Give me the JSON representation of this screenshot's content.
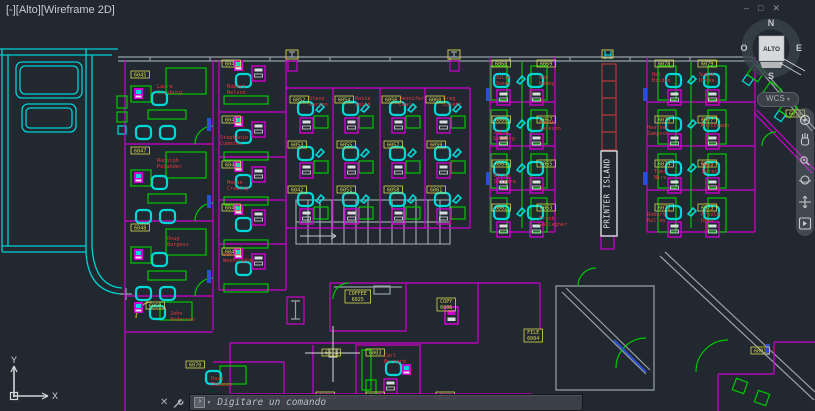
{
  "app": {
    "viewport_controls": [
      "[-]",
      "[Alto]",
      "[Wireframe 2D]"
    ],
    "window_buttons": {
      "minimize": "–",
      "restore": "□",
      "close": "✕"
    }
  },
  "viewcube": {
    "north": "N",
    "south": "S",
    "east": "E",
    "west": "O",
    "top_face": "ALTO",
    "wcs_label": "WCS",
    "wcs_dropdown": "▾"
  },
  "navbar": {
    "icons": [
      "navigation-wheel",
      "pan-hand",
      "zoom",
      "orbit",
      "pan-arrows",
      "show-more"
    ]
  },
  "command_bar": {
    "close_glyph": "✕",
    "dropdown_glyph": "▾",
    "recent_glyph": "›",
    "prompt": "Digitare un comando"
  },
  "ucs": {
    "x_label": "X",
    "y_label": "Y"
  },
  "plan": {
    "printer_island": "PRINTER  ISLAND",
    "colors": {
      "tag": "#d8d84e",
      "name": "#e23b3b",
      "island_text": "#dfe3e6"
    },
    "tags": [
      {
        "t": "6045",
        "x": 131,
        "y": 71
      },
      {
        "t": "6047",
        "x": 131,
        "y": 147
      },
      {
        "t": "6048",
        "x": 131,
        "y": 224
      },
      {
        "t": "6050",
        "x": 146,
        "y": 302
      },
      {
        "t": "6070",
        "x": 186,
        "y": 361
      },
      {
        "t": "6041",
        "x": 222,
        "y": 60
      },
      {
        "t": "6043",
        "x": 222,
        "y": 116
      },
      {
        "t": "6044",
        "x": 222,
        "y": 161
      },
      {
        "t": "6046",
        "x": 222,
        "y": 204
      },
      {
        "t": "6049",
        "x": 222,
        "y": 248
      },
      {
        "t": "6052",
        "x": 290,
        "y": 96
      },
      {
        "t": "6054",
        "x": 335,
        "y": 96
      },
      {
        "t": "6056",
        "x": 382,
        "y": 96
      },
      {
        "t": "6060",
        "x": 426,
        "y": 96
      },
      {
        "t": "6053",
        "x": 288,
        "y": 141
      },
      {
        "t": "6055",
        "x": 337,
        "y": 141
      },
      {
        "t": "6057",
        "x": 384,
        "y": 141
      },
      {
        "t": "6059",
        "x": 427,
        "y": 141
      },
      {
        "t": "6042",
        "x": 288,
        "y": 186
      },
      {
        "t": "6051",
        "x": 337,
        "y": 186
      },
      {
        "t": "6058",
        "x": 384,
        "y": 186
      },
      {
        "t": "6061",
        "x": 427,
        "y": 186
      },
      {
        "t": "6068",
        "x": 492,
        "y": 60
      },
      {
        "t": "6069",
        "x": 537,
        "y": 60
      },
      {
        "t": "6066",
        "x": 492,
        "y": 116
      },
      {
        "t": "6067",
        "x": 537,
        "y": 116
      },
      {
        "t": "6064",
        "x": 492,
        "y": 160
      },
      {
        "t": "6065",
        "x": 537,
        "y": 160
      },
      {
        "t": "6062",
        "x": 492,
        "y": 204
      },
      {
        "t": "6063",
        "x": 537,
        "y": 204
      },
      {
        "t": "6078",
        "x": 655,
        "y": 60
      },
      {
        "t": "6079",
        "x": 698,
        "y": 60
      },
      {
        "t": "6076",
        "x": 655,
        "y": 116
      },
      {
        "t": "6077",
        "x": 698,
        "y": 116
      },
      {
        "t": "6074",
        "x": 655,
        "y": 160
      },
      {
        "t": "6075",
        "x": 698,
        "y": 160
      },
      {
        "t": "6072",
        "x": 655,
        "y": 204
      },
      {
        "t": "6073",
        "x": 698,
        "y": 204
      },
      {
        "t": "6010",
        "x": 786,
        "y": 110
      },
      {
        "t": "6001",
        "x": 751,
        "y": 347
      },
      {
        "t": "6011",
        "x": 322,
        "y": 349
      },
      {
        "t": "6003",
        "x": 366,
        "y": 349
      },
      {
        "t": "6021",
        "x": 316,
        "y": 392
      },
      {
        "t": "6023",
        "x": 366,
        "y": 392
      },
      {
        "t": "6015",
        "x": 436,
        "y": 392
      }
    ],
    "tags2": [
      {
        "l1": "COFFEE",
        "l2": "6025",
        "x": 345,
        "y": 290
      },
      {
        "l1": "COPY",
        "l2": "6006",
        "x": 437,
        "y": 298
      },
      {
        "l1": "FILE",
        "l2": "6004",
        "x": 524,
        "y": 329
      }
    ],
    "names": [
      {
        "t": "Laura\nGinsburg",
        "x": 157,
        "y": 88
      },
      {
        "t": "Rudolph\nPolander",
        "x": 157,
        "y": 162
      },
      {
        "t": "Doug\nBurgess",
        "x": 167,
        "y": 240
      },
      {
        "t": "John\nAnderson",
        "x": 170,
        "y": 315
      },
      {
        "t": "Dave\nThommes",
        "x": 211,
        "y": 380
      },
      {
        "t": "Robert\nNelson",
        "x": 227,
        "y": 88
      },
      {
        "t": "Stephanie\nCummins",
        "x": 220,
        "y": 139
      },
      {
        "t": "Megan\nCrowley",
        "x": 227,
        "y": 184
      },
      {
        "t": "Sam\nWashington",
        "x": 223,
        "y": 256
      },
      {
        "t": "Steve\nLarson",
        "x": 309,
        "y": 100
      },
      {
        "t": "Rosie\nSmith",
        "x": 355,
        "y": 100
      },
      {
        "t": "Jennifer\nChai",
        "x": 399,
        "y": 100
      },
      {
        "t": "Greg\nLovett",
        "x": 443,
        "y": 100
      },
      {
        "t": "Julie\nJones",
        "x": 495,
        "y": 79
      },
      {
        "t": "Bob\nRahmy",
        "x": 539,
        "y": 79
      },
      {
        "t": "Julie\nSeeborg",
        "x": 493,
        "y": 134
      },
      {
        "t": "Keith\nJackson",
        "x": 539,
        "y": 124
      },
      {
        "t": "Elise\nSilvera",
        "x": 494,
        "y": 177
      },
      {
        "t": "Frank\nGallagher",
        "x": 539,
        "y": 220
      },
      {
        "t": "Hal\nBrides",
        "x": 652,
        "y": 76
      },
      {
        "t": "Susan\nDrake",
        "x": 699,
        "y": 76
      },
      {
        "t": "Heather\nSampson",
        "x": 647,
        "y": 129
      },
      {
        "t": "Art\nMuscovado",
        "x": 701,
        "y": 121
      },
      {
        "t": "Tami\nNiro",
        "x": 654,
        "y": 173
      },
      {
        "t": "Patti\nMoret",
        "x": 702,
        "y": 167
      },
      {
        "t": "Robert\nKelley",
        "x": 647,
        "y": 216
      },
      {
        "t": "Arnold\nDean",
        "x": 701,
        "y": 216
      },
      {
        "t": "Carl\nBernard",
        "x": 384,
        "y": 357
      }
    ]
  }
}
